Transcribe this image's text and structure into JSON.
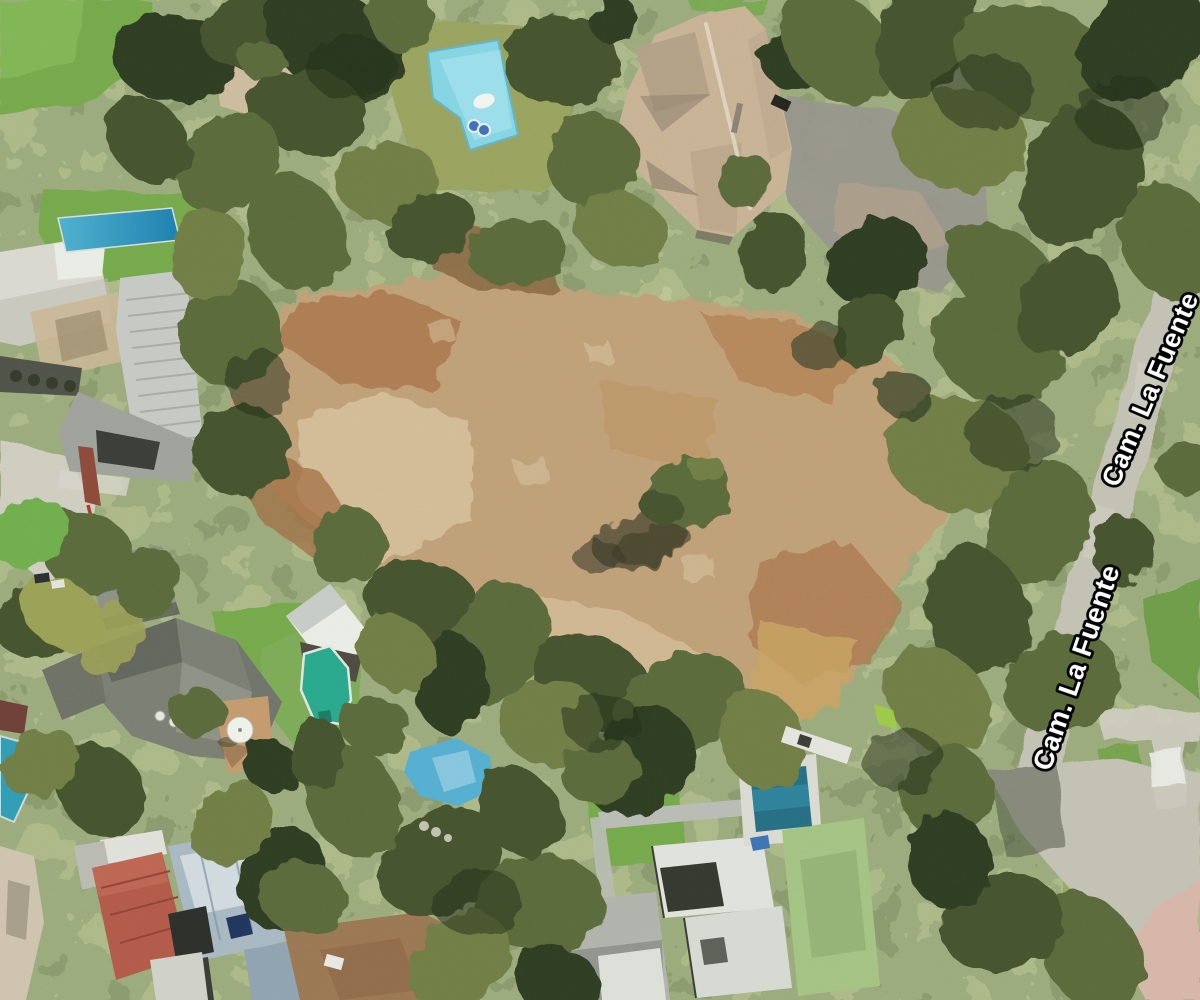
{
  "map": {
    "view_type": "3d-satellite-aerial",
    "street_name": "Cam. La Fuente",
    "labels": [
      {
        "text": "Cam. La Fuente",
        "rotation_deg": -67
      },
      {
        "text": "Cam. La Fuente",
        "rotation_deg": -71
      }
    ],
    "colors": {
      "tree_deep": "#2f3c23",
      "tree_dark": "#44522e",
      "tree_mid": "#5a6a3a",
      "tree_olive": "#707e45",
      "tree_yellow": "#9aa055",
      "tree_bright": "#6fae4d",
      "lawn": "#74a94c",
      "lawn_olive": "#99a35e",
      "dirt": "#bfa078",
      "dirt_light": "#d8c6a2",
      "dirt_orange": "#a9744a",
      "dirt_gold": "#c7a263",
      "dirt_brown": "#8a6a44",
      "pool_cyan": "#85d4e3",
      "pool_teal": "#2f93bb",
      "pool_green": "#28a88c",
      "pool_deep": "#256e84",
      "pool_sky": "#55aed0",
      "roof_beige": "#c8b295",
      "roof_white": "#e9ebe5",
      "roof_gray": "#b5b8b1",
      "roof_charcoal": "#6b6e62",
      "roof_red": "#b25a4a",
      "roof_steel": "#a8b8c2",
      "pavement": "#c3c1b4",
      "concrete": "#cfccc0",
      "label_fill": "#ffffff",
      "label_outline": "#000000"
    }
  }
}
